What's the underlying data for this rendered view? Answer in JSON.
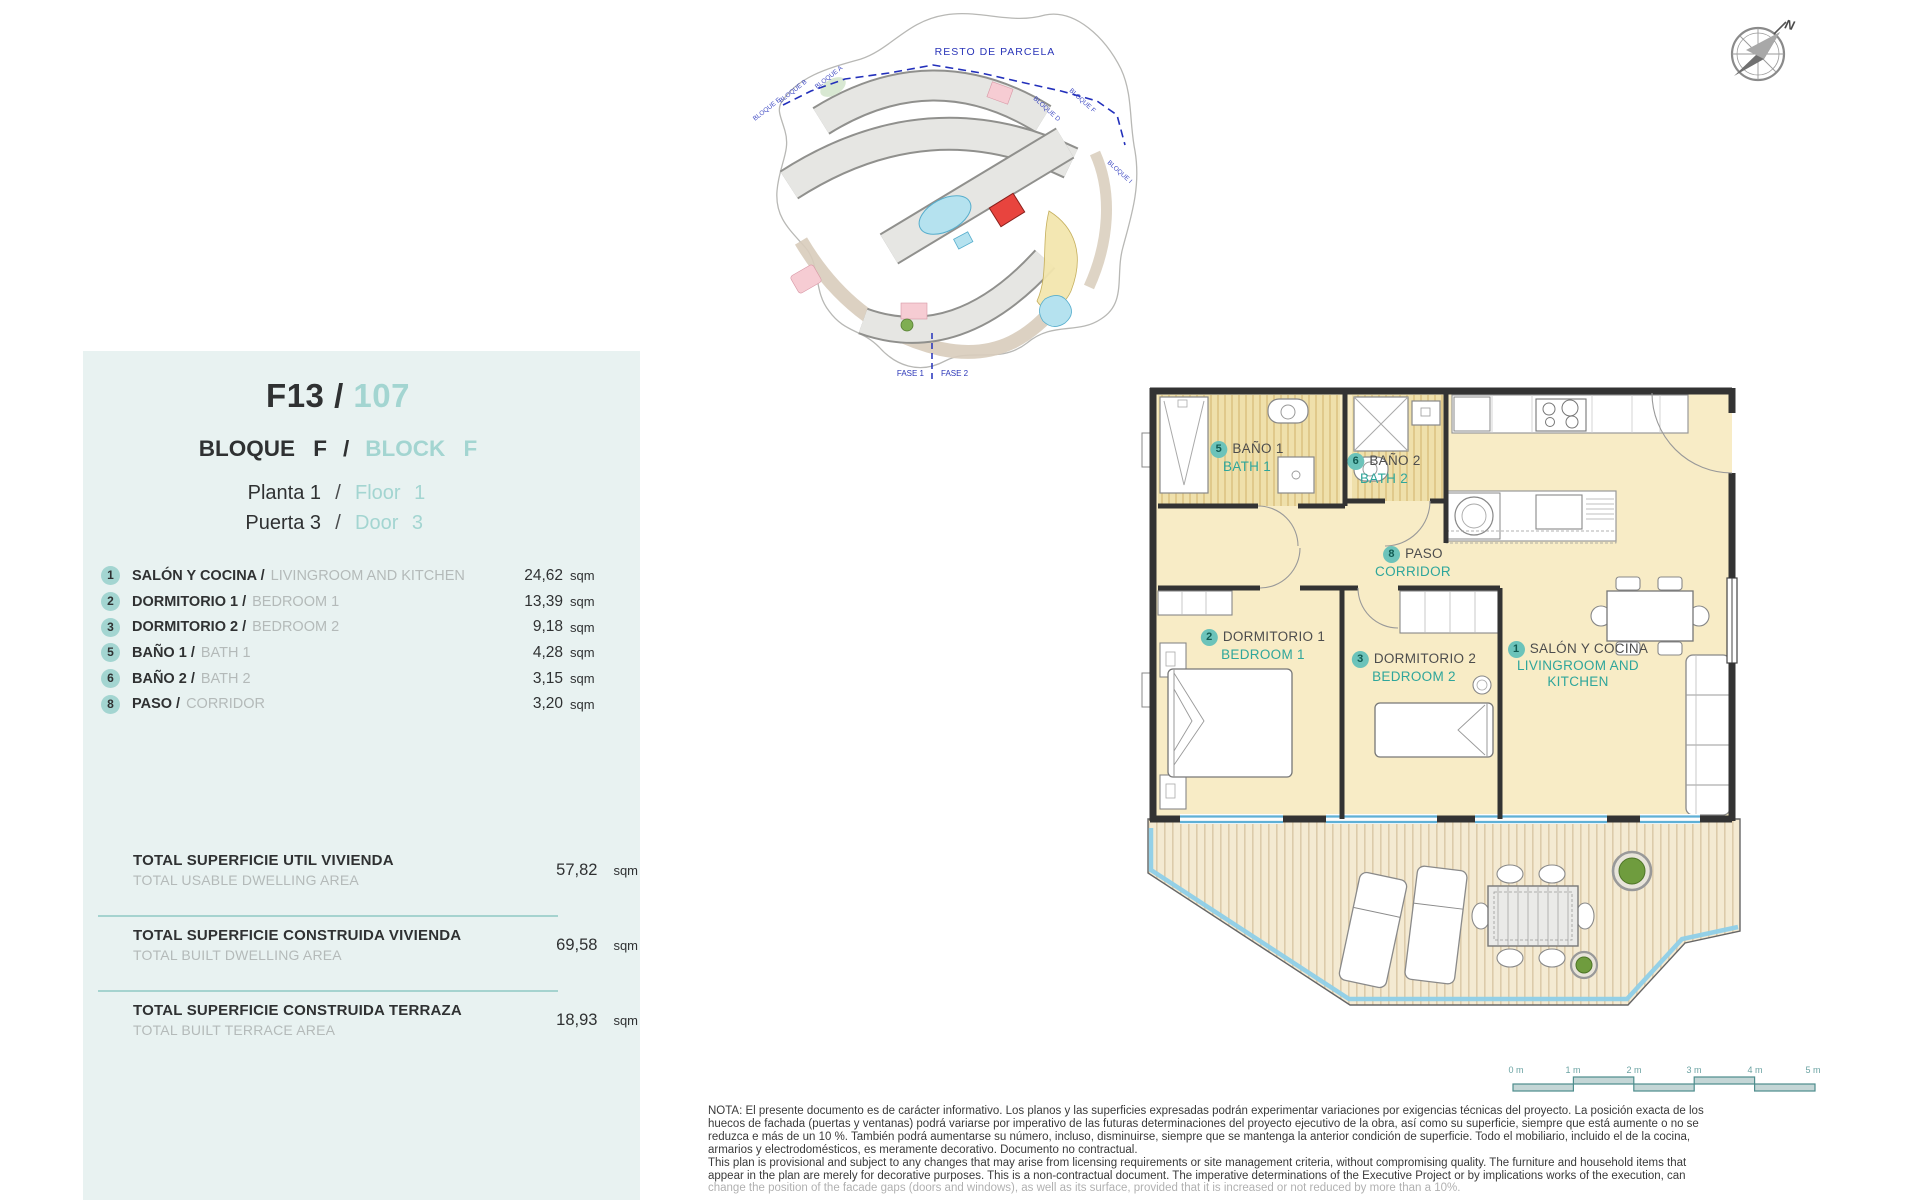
{
  "colors": {
    "accent_teal": "#a3d5d1",
    "plan_teal": "#2fa69b",
    "divider_teal": "#a5d3cf",
    "highlight_red": "#e8423d",
    "parcel_blue": "#2a35b8",
    "wall": "#333333",
    "room_fill": "#f8ecc6",
    "panel_bg": "#e8f2f1"
  },
  "panel": {
    "unit_code": "F13 /",
    "unit_number": "107",
    "slash": "/",
    "block_es": "BLOQUE F",
    "block_en": "BLOCK F",
    "floor_es": "Planta 1",
    "floor_en": "Floor 1",
    "door_es": "Puerta 3",
    "door_en": "Door 3",
    "rooms": [
      {
        "num": "1",
        "es": "SALÓN Y COCINA /",
        "en": "LIVINGROOM AND KITCHEN",
        "area": "24,62",
        "unit": "sqm"
      },
      {
        "num": "2",
        "es": "DORMITORIO 1 /",
        "en": "BEDROOM 1",
        "area": "13,39",
        "unit": "sqm"
      },
      {
        "num": "3",
        "es": "DORMITORIO 2 /",
        "en": "BEDROOM 2",
        "area": "9,18",
        "unit": "sqm"
      },
      {
        "num": "5",
        "es": "BAÑO 1 /",
        "en": "BATH 1",
        "area": "4,28",
        "unit": "sqm"
      },
      {
        "num": "6",
        "es": "BAÑO 2 /",
        "en": "BATH 2",
        "area": "3,15",
        "unit": "sqm"
      },
      {
        "num": "8",
        "es": "PASO /",
        "en": "CORRIDOR",
        "area": "3,20",
        "unit": "sqm"
      }
    ],
    "totals": [
      {
        "es": "TOTAL SUPERFICIE UTIL VIVIENDA",
        "en": "TOTAL USABLE DWELLING AREA",
        "value": "57,82",
        "unit": "sqm"
      },
      {
        "es": "TOTAL SUPERFICIE CONSTRUIDA VIVIENDA",
        "en": "TOTAL BUILT DWELLING AREA",
        "value": "69,58",
        "unit": "sqm"
      },
      {
        "es": "TOTAL SUPERFICIE CONSTRUIDA TERRAZA",
        "en": "TOTAL BUILT TERRACE AREA",
        "value": "18,93",
        "unit": "sqm"
      }
    ]
  },
  "site_plan": {
    "resto_label": "RESTO DE PARCELA",
    "fase1": "FASE 1",
    "fase2": "FASE 2",
    "blocks": [
      "BLOQUE E",
      "BLOQUE B",
      "BLOQUE A",
      "BLOQUE D",
      "BLOQUE F",
      "BLOQUE I"
    ]
  },
  "floor_plan": {
    "rooms": [
      {
        "num": "5",
        "es": "BAÑO 1",
        "en": "BATH 1"
      },
      {
        "num": "6",
        "es": "BAÑO 2",
        "en": "BATH 2"
      },
      {
        "num": "8",
        "es": "PASO",
        "en": "CORRIDOR"
      },
      {
        "num": "2",
        "es": "DORMITORIO 1",
        "en": "BEDROOM 1"
      },
      {
        "num": "3",
        "es": "DORMITORIO 2",
        "en": "BEDROOM 2"
      },
      {
        "num": "1",
        "es": "SALÓN Y COCINA",
        "en": "LIVINGROOM AND KITCHEN"
      }
    ]
  },
  "compass": {
    "north": "N"
  },
  "scale_bar": {
    "labels": [
      "0 m",
      "1 m",
      "2 m",
      "3 m",
      "4 m",
      "5 m"
    ]
  },
  "note": {
    "lines": [
      "NOTA: El presente documento es de carácter informativo. Los planos y las superficies expresadas podrán experimentar variaciones por exigencias técnicas del proyecto. La posición exacta de los",
      "huecos de fachada (puertas y ventanas) podrá variarse por imperativo de las futuras determinaciones del proyecto ejecutivo de la obra, así como su superficie, siempre que está aumente o no se",
      "reduzca e más de un 10 %. También podrá aumentarse su número, incluso, disminuirse, siempre que se mantenga la anterior condición de superficie. Todo el mobiliario, incluido el de la cocina,",
      "armarios y electrodomésticos, es meramente decorativo. Documento no contractual.",
      "This plan is provisional and subject to any changes that may arise from licensing requirements or site management criteria, without compromising quality. The furniture and household items that",
      "appear in the plan are merely for decorative purposes. This is a non-contractual document. The imperative determinations of the Executive Project or by implications works of the execution, can",
      "change the position of the facade gaps (doors and windows), as well as its surface, provided that it is increased or not reduced by more than a 10%."
    ]
  }
}
